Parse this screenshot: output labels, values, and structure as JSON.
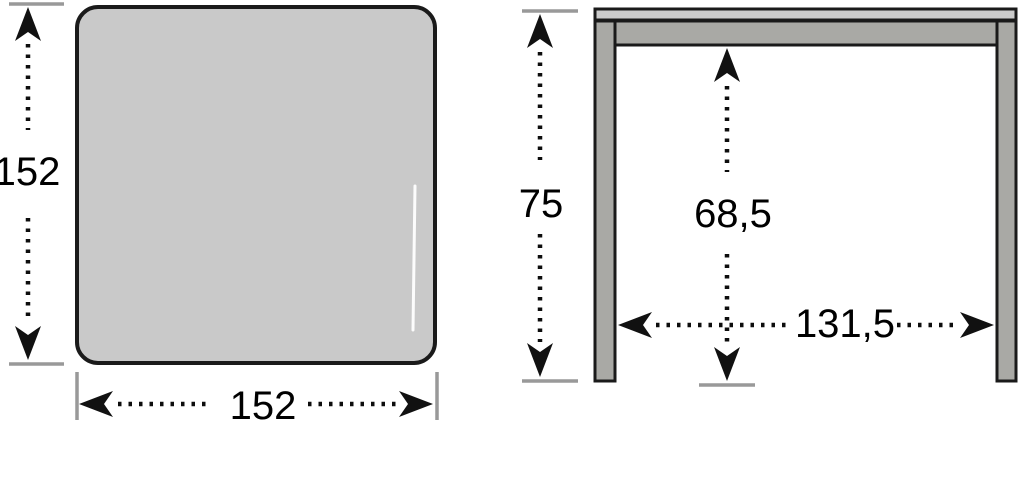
{
  "diagram": {
    "kind": "furniture dimension drawing (table, top view and side view)",
    "top_view": {
      "height_label": "152",
      "width_label": "152"
    },
    "side_view": {
      "overall_height_label": "75",
      "clearance_height_label": "68,5",
      "clearance_width_label": "131,5"
    },
    "icons": {
      "dimension_arrows": [
        "arrow-up-icon",
        "arrow-down-icon",
        "arrow-left-icon",
        "arrow-right-icon"
      ]
    },
    "colors": {
      "tabletop_fill": "#c9c9c9",
      "tabletop_edge_fill": "#cbcbcb",
      "frame_fill": "#a9a9a5",
      "outline": "#1a1a1a",
      "extension_tick": "#999999",
      "dimension_ink": "#0d0d0d",
      "highlight": "#ffffff",
      "background": "#ffffff"
    }
  }
}
